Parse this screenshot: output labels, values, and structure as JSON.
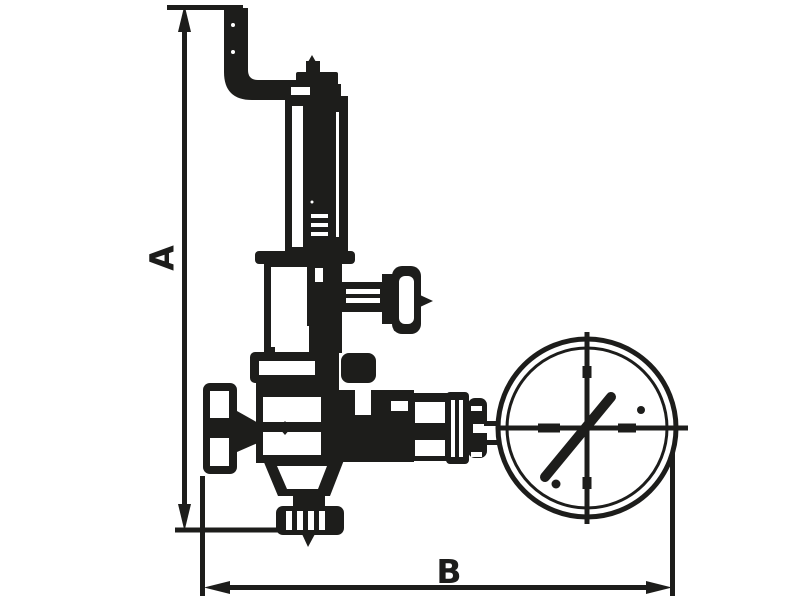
{
  "drawing": {
    "kind": "technical-line-drawing",
    "dimensions": {
      "vertical_label": "A",
      "horizontal_label": "B"
    },
    "colors": {
      "line": "#1d1d1b",
      "background": "#ffffff"
    }
  }
}
